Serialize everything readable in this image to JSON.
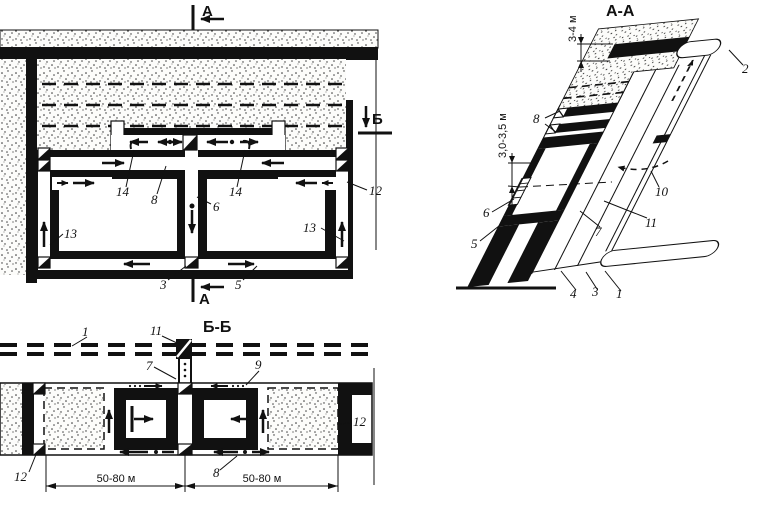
{
  "colors": {
    "ink": "#111111",
    "paper": "#ffffff"
  },
  "plan": {
    "marker_top": "А",
    "marker_bottom": "А",
    "marker_side": "Б",
    "labels": {
      "n14a": "14",
      "n8": "8",
      "n14b": "14",
      "n6": "6",
      "n12": "12",
      "n13a": "13",
      "n13b": "13",
      "n3": "3",
      "n5": "5"
    }
  },
  "section_aa": {
    "title": "А-А",
    "dims": {
      "surface": "3-4 м",
      "chamber": "3,0-3,5 м"
    },
    "labels": {
      "n8": "8",
      "n6": "6",
      "n5": "5",
      "n7": "7",
      "n10": "10",
      "n11": "11",
      "n4": "4",
      "n3": "3",
      "n1": "1",
      "n2": "2"
    }
  },
  "section_bb": {
    "title": "Б-Б",
    "dims": {
      "left": "50-80 м",
      "right": "50-80 м"
    },
    "labels": {
      "n1": "1",
      "n11": "11",
      "n7": "7",
      "n9": "9",
      "n12r": "12",
      "n12l": "12",
      "n8": "8"
    }
  }
}
